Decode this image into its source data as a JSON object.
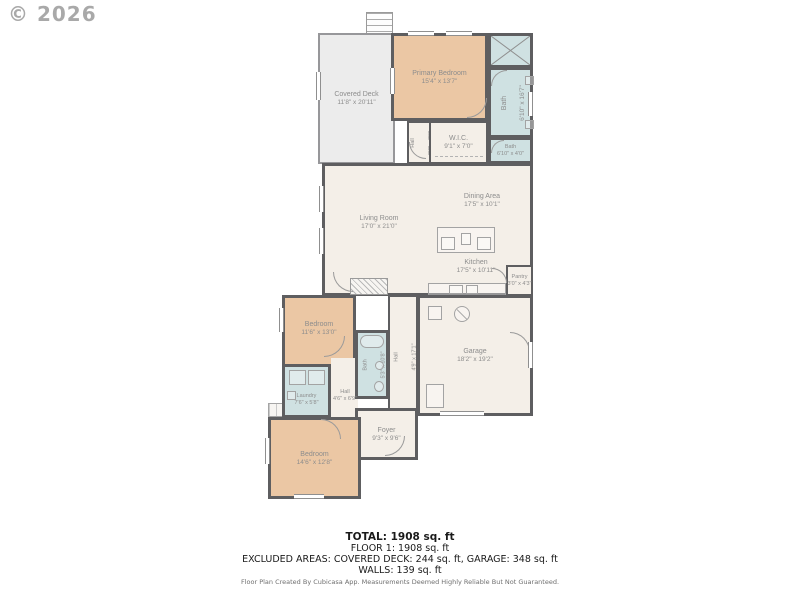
{
  "watermark": "© 2026",
  "rooms": {
    "covered_deck": {
      "name": "Covered Deck",
      "dims": "11'8\" x 20'11\""
    },
    "primary_bedroom": {
      "name": "Primary Bedroom",
      "dims": "15'4\" x 13'7\""
    },
    "bath_primary": {
      "name": "Bath",
      "dims": "6'10\" x 16'7\""
    },
    "bath_small": {
      "name": "Bath",
      "dims": "6'10\" x 4'0\""
    },
    "hall_upper": {
      "name": "Hall",
      "dims": "3'6\" x 7'0\""
    },
    "wic": {
      "name": "W.I.C.",
      "dims": "9'1\" x 7'0\""
    },
    "living_room": {
      "name": "Living Room",
      "dims": "17'0\" x 21'0\""
    },
    "dining_area": {
      "name": "Dining Area",
      "dims": "17'5\" x 10'1\""
    },
    "kitchen": {
      "name": "Kitchen",
      "dims": "17'5\" x 10'11\""
    },
    "pantry": {
      "name": "Pantry",
      "dims": "3'0\" x 4'3\""
    },
    "bedroom_mid": {
      "name": "Bedroom",
      "dims": "11'6\" x 13'0\""
    },
    "bath_mid": {
      "name": "Bath",
      "dims": "5'3\" x 10'8\""
    },
    "hall_mid": {
      "name": "Hall",
      "dims": "4'9\" x 17'1\""
    },
    "garage": {
      "name": "Garage",
      "dims": "18'2\" x 19'2\""
    },
    "laundry": {
      "name": "Laundry",
      "dims": "7'6\" x 5'8\""
    },
    "hall_lower": {
      "name": "Hall",
      "dims": "4'6\" x 6'9\""
    },
    "foyer": {
      "name": "Foyer",
      "dims": "9'3\" x 9'6\""
    },
    "bedroom_bottom": {
      "name": "Bedroom",
      "dims": "14'6\" x 12'8\""
    }
  },
  "summary": {
    "total": "TOTAL: 1908 sq. ft",
    "floor1": "FLOOR 1: 1908 sq. ft",
    "excluded": "EXCLUDED AREAS: COVERED DECK: 244 sq. ft, GARAGE: 348 sq. ft",
    "walls": "WALLS: 139 sq. ft"
  },
  "footer": {
    "note": "Floor Plan Created By Cubicasa App. Measurements Deemed Highly Reliable But Not Guaranteed."
  },
  "colors": {
    "wall": "#5e5e60",
    "bedroom_fill": "#ebc7a4",
    "wet_room_fill": "#cfe1e2",
    "floor_fill": "#f4efe8",
    "deck_fill": "#ececec",
    "label_text": "#8d8d8d",
    "summary_text": "#1a1a1a"
  }
}
